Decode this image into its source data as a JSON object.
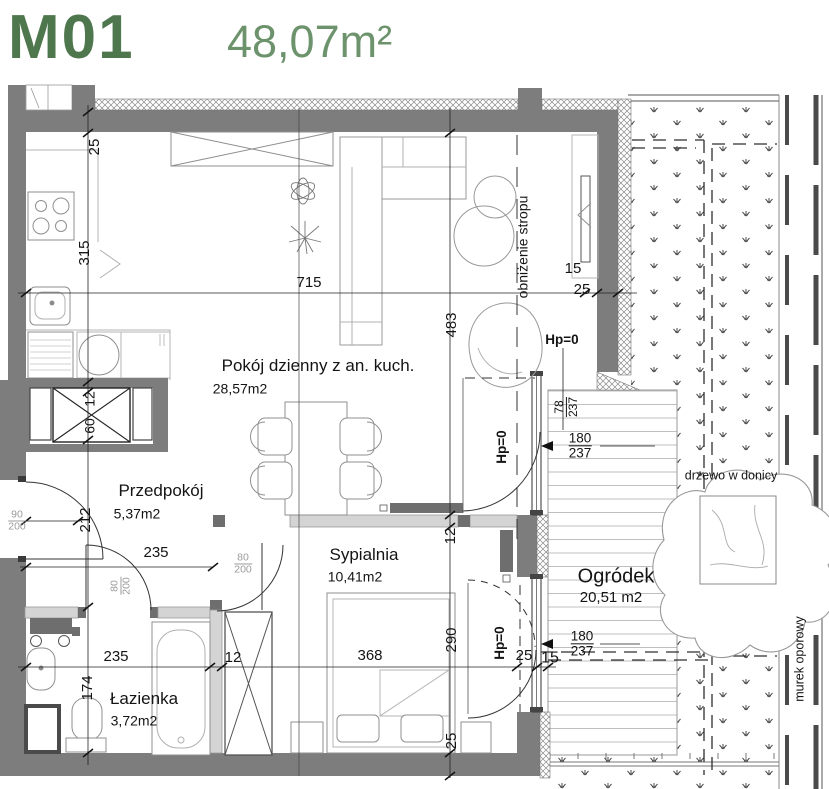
{
  "header": {
    "unit_id": "M01",
    "unit_area": "48,07m²"
  },
  "rooms": {
    "living": {
      "name": "Pokój dzienny z an. kuch.",
      "area": "28,57m2"
    },
    "hall": {
      "name": "Przedpokój",
      "area": "5,37m2"
    },
    "bedroom": {
      "name": "Sypialnia",
      "area": "10,41m2"
    },
    "bath": {
      "name": "Łazienka",
      "area": "3,72m2"
    },
    "garden": {
      "name": "Ogródek",
      "area": "20,51  m2"
    }
  },
  "annotations": {
    "ceiling_drop": "obniżenie stropu",
    "tree": "drzewo w donicy",
    "retaining_wall": "murek oporowy",
    "floor_level_a": "Hp=0",
    "floor_level_b": "Hp=0",
    "floor_level_c": "Hp=0"
  },
  "dimensions": {
    "top_wall_25": "25",
    "kitchen_315": "315",
    "living_715": "715",
    "living_483": "483",
    "tv_15": "15",
    "right_wall_25": "25",
    "niche_12": "12",
    "wardrobe_60": "60",
    "hall_212": "212",
    "hall_235": "235",
    "entry_90": "90",
    "entry_200": "200",
    "bathdoor_80": "80",
    "bathdoor_200": "200",
    "beddoor_80": "80",
    "beddoor_200": "200",
    "bath_235": "235",
    "bath_174": "174",
    "part_12": "12",
    "bed_368": "368",
    "bed_290": "290",
    "bottom_25": "25",
    "living_part_12": "12",
    "jamb_25": "25",
    "jamb_15": "15",
    "win_78": "78",
    "win_78_h": "237",
    "livdoor_180": "180",
    "livdoor_237": "237",
    "beddoor_180": "180",
    "beddoor_237": "237"
  },
  "colors": {
    "accent_green": "#4e774e",
    "wall_gray": "#7d7d7d"
  }
}
